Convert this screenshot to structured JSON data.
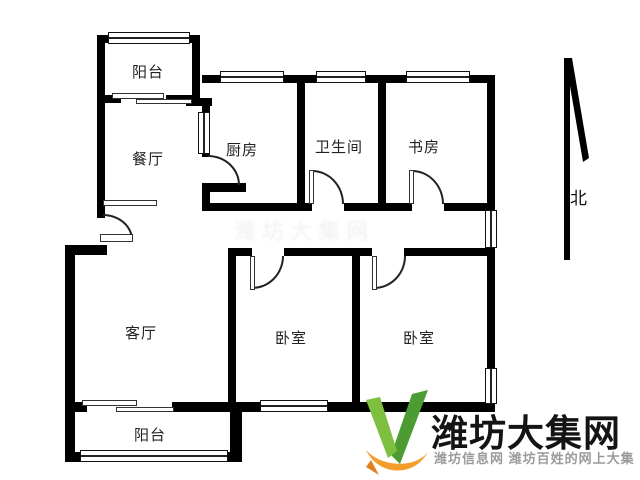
{
  "colors": {
    "wall": "#000000",
    "line": "#222222",
    "background": "#ffffff"
  },
  "floorplan": {
    "rooms": [
      {
        "name": "balcony-top",
        "label": "阳台"
      },
      {
        "name": "dining",
        "label": "餐厅"
      },
      {
        "name": "kitchen",
        "label": "厨房"
      },
      {
        "name": "bathroom",
        "label": "卫生间"
      },
      {
        "name": "study",
        "label": "书房"
      },
      {
        "name": "living",
        "label": "客厅"
      },
      {
        "name": "bedroom-left",
        "label": "卧室"
      },
      {
        "name": "bedroom-right",
        "label": "卧室"
      },
      {
        "name": "balcony-bottom",
        "label": "阳台"
      }
    ],
    "compass_label": "北",
    "faint_center_watermark": "潍坊大集网"
  },
  "watermark": {
    "title": "潍坊大集网",
    "subtitle": "潍坊信息网 潍坊百姓的网上大集",
    "logo": {
      "green_light": "#7fbf3f",
      "green_dark": "#4d9c33",
      "orange": "#f49d2c"
    },
    "title_color": "#141414",
    "subtitle_color": "#9b9b9b"
  }
}
